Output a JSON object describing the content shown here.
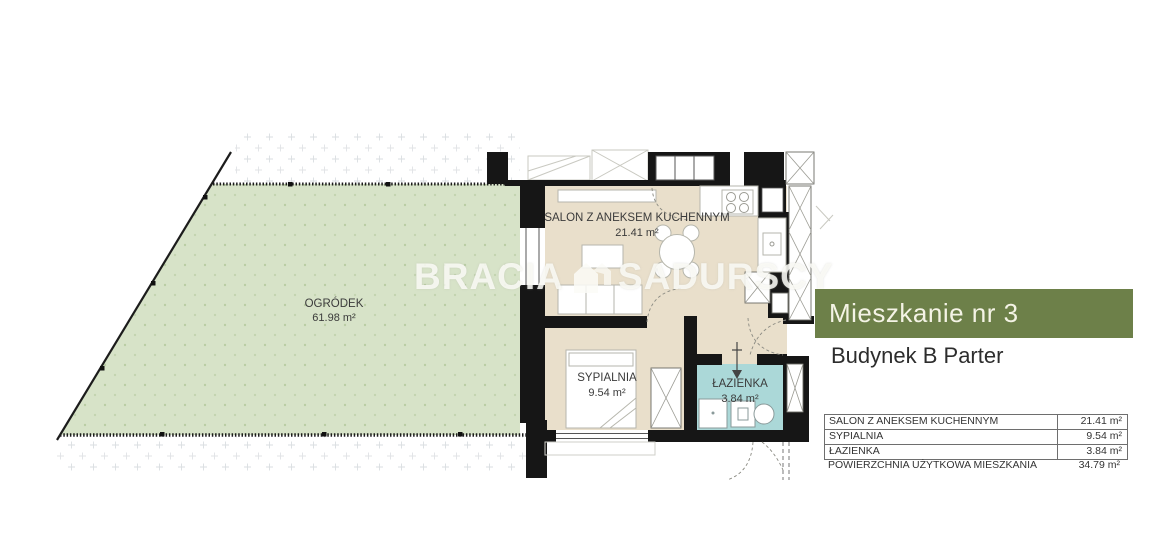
{
  "plan": {
    "watermark": {
      "brand_left": "BRACIA",
      "brand_right": "SADURSCY"
    },
    "garden": {
      "name": "OGRÓDEK",
      "area": "61.98 m²"
    },
    "salon": {
      "name": "SALON Z ANEKSEM KUCHENNYM",
      "area": "21.41 m²"
    },
    "bedroom": {
      "name": "SYPIALNIA",
      "area": "9.54 m²"
    },
    "bathroom": {
      "name": "ŁAZIENKA",
      "area": "3.84 m²"
    }
  },
  "panel": {
    "title": "Mieszkanie nr 3",
    "subtitle": "Budynek B Parter",
    "table": {
      "rows": [
        {
          "label": "SALON Z ANEKSEM KUCHENNYM",
          "value": "21.41 m²"
        },
        {
          "label": "SYPIALNIA",
          "value": "9.54 m²"
        },
        {
          "label": "ŁAZIENKA",
          "value": "3.84 m²"
        }
      ],
      "total": {
        "label": "POWIERZCHNIA UŻYTKOWA MIESZKANIA",
        "value": "34.79 m²"
      }
    }
  },
  "colors": {
    "header_green": "#6d8049",
    "garden_green": "#d7e3c8",
    "floor_beige": "#e9dfcb",
    "bathroom_teal": "#abd8d8",
    "wall_black": "#161616"
  }
}
